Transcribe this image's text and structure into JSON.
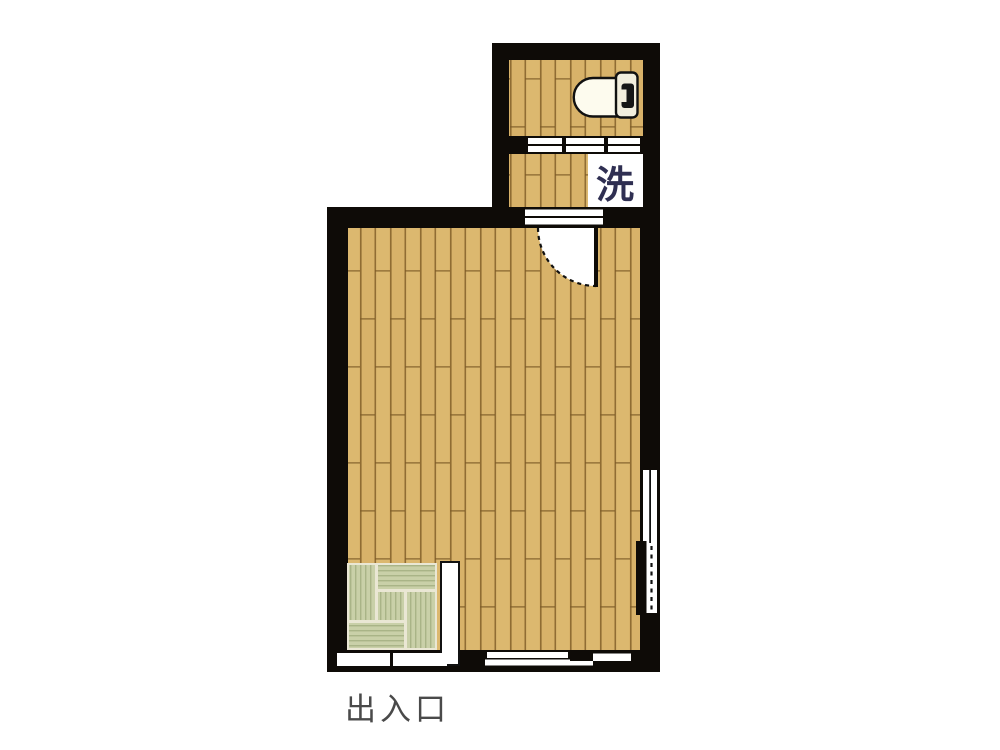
{
  "floorplan": {
    "description": "japanese-apartment-room-floorplan",
    "labels": {
      "washing_machine": "洗",
      "entrance": "出入口"
    },
    "regions": [
      {
        "name": "toilet-room",
        "floor": "wood"
      },
      {
        "name": "washroom",
        "floor": "wood"
      },
      {
        "name": "main-room",
        "floor": "wood"
      },
      {
        "name": "tatami-corner",
        "floor": "tatami",
        "mats": 5
      }
    ],
    "fixtures": [
      "toilet-bowl-with-tank",
      "washing-machine-space",
      "hinged-door-swing-arc",
      "sliding-door-toilet-washroom",
      "sliding-door-washroom-mainroom",
      "entrance-sliding-panels",
      "bottom-wall-sliding-door",
      "right-wall-window-upper",
      "right-wall-window-lower-dashed",
      "closet-strip"
    ],
    "colors": {
      "wall": "#0e0b07",
      "wood_base": "#d8b269",
      "wood_grain": "#7d5a26",
      "tatami_base": "#c9d0a8",
      "tatami_stripe": "#a9b487",
      "tatami_gap": "#eae7d4",
      "fixture_fill": "#fdfbee",
      "tank_fill": "#f2eedd",
      "door_white": "#ffffff",
      "label_text": "#4a4a4a",
      "kanji_navy": "#2f2f52"
    }
  }
}
